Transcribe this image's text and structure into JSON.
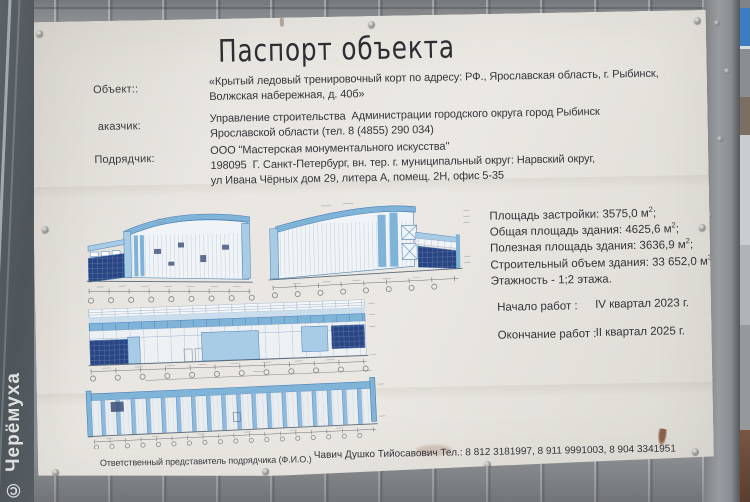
{
  "watermark": "© Черёмуха",
  "board": {
    "title": "Паспорт объекта",
    "fields": [
      {
        "label": "Объект::",
        "lines": [
          "«Крытый ледовый тренировочный корт по адресу: РФ., Ярославская область, г. Рыбинск,",
          "Волжская набережная, д. 40б»"
        ]
      },
      {
        "label": "аказчик:",
        "lines": [
          "Управление строительства  Администрации городского округа город Рыбинск",
          "Ярославской области (тел. 8 (4855) 290 034)"
        ]
      },
      {
        "label": "Подрядчик:",
        "lines": [
          "ООО \"Мастерская монументального искусства\"",
          "198095  Г. Санкт-Петербург, вн. тер. г. муниципальный округ: Нарвский округ,",
          "ул Ивана Чёрных дом 29, литера А, помещ. 2Н, офис 5-35"
        ]
      }
    ],
    "stats": [
      {
        "text": "Площадь застройки: 3575,0 м",
        "sup": "2",
        "tail": ";"
      },
      {
        "text": "Общая площадь здания: 4625,6 м",
        "sup": "2",
        "tail": ";"
      },
      {
        "text": "Полезная площадь здания: 3636,9 м",
        "sup": "2",
        "tail": ";"
      },
      {
        "text": "Строительный объем здания: 33 652,0 м",
        "sup": "3",
        "tail": ","
      },
      {
        "text": "Этажность - 1;2 этажа.",
        "sup": "",
        "tail": ""
      }
    ],
    "schedule": [
      {
        "label": "Начало работ :",
        "value": "IV квартал 2023 г."
      },
      {
        "label": "Окончание работ :",
        "value": "II квартал 2025 г."
      }
    ],
    "footer": {
      "label": "Ответственный представитель подрядчика (Ф.И.О.)",
      "value": "Чавич Душко Тийосавович Тел.: 8 812 3181997, 8 911 9991003, 8 904 3341951"
    }
  },
  "colors": {
    "fence_gray": "#8d9194",
    "board_white": "#ebe8e3",
    "text_dark": "#333338",
    "drawing_outline": "#4a7fb5",
    "drawing_light_blue": "#a9cce6",
    "drawing_mid_blue": "#7fb3d8",
    "drawing_glazing_navy": "#2a4583",
    "drawing_pale_blue": "#c9ddec",
    "sign_blue": "#3b7dc0",
    "ground_brown": "#6e4c3a",
    "watermark_white": "#ececea"
  }
}
